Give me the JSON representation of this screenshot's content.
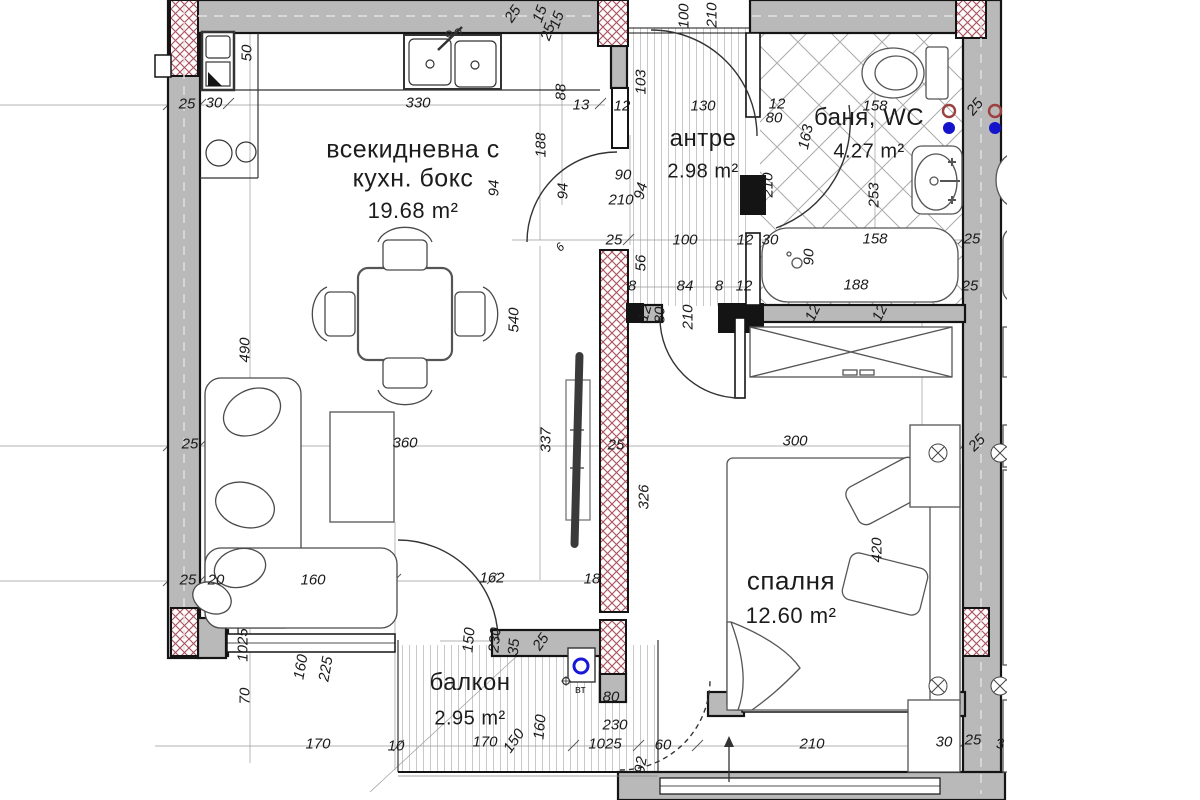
{
  "plan": {
    "rooms": [
      {
        "lines": [
          "всекидневна с",
          "кухн. бокс"
        ],
        "area": "19.68 m²",
        "x": 413,
        "y": 150,
        "lh": 29,
        "ns": 25,
        "as": 22,
        "ay": 211
      },
      {
        "lines": [
          "антре"
        ],
        "area": "2.98 m²",
        "x": 703,
        "y": 139,
        "lh": 26,
        "ns": 24,
        "as": 20,
        "ay": 172
      },
      {
        "lines": [
          "баня, WC"
        ],
        "area": "4.27 m²",
        "x": 869,
        "y": 118,
        "lh": 26,
        "ns": 24,
        "as": 20,
        "ay": 152
      },
      {
        "lines": [
          "спалня"
        ],
        "area": "12.60 m²",
        "x": 791,
        "y": 581,
        "lh": 28,
        "ns": 26,
        "as": 22,
        "ay": 616
      },
      {
        "lines": [
          "балкон"
        ],
        "area": "2.95 m²",
        "x": 470,
        "y": 683,
        "lh": 26,
        "ns": 24,
        "as": 20,
        "ay": 719
      }
    ],
    "dimensions": [
      [
        "50",
        247,
        53,
        -90
      ],
      [
        "25",
        187,
        104
      ],
      [
        "30",
        214,
        103
      ],
      [
        "330",
        418,
        103
      ],
      [
        "25",
        513,
        14,
        -55
      ],
      [
        "15",
        540,
        14,
        -70
      ],
      [
        "25",
        548,
        32,
        -70
      ],
      [
        "15",
        557,
        20,
        -70
      ],
      [
        "88",
        561,
        92,
        -90
      ],
      [
        "13",
        581,
        105
      ],
      [
        "12",
        622,
        106
      ],
      [
        "103",
        641,
        82,
        -90
      ],
      [
        "130",
        703,
        106
      ],
      [
        "100",
        684,
        16,
        -90
      ],
      [
        "210",
        712,
        15,
        -90
      ],
      [
        "188",
        541,
        145,
        -90
      ],
      [
        "94",
        494,
        188,
        -90
      ],
      [
        "94",
        563,
        191,
        -90
      ],
      [
        "94",
        641,
        191,
        -75
      ],
      [
        "90",
        623,
        175
      ],
      [
        "210",
        621,
        200
      ],
      [
        "12",
        777,
        104
      ],
      [
        "80",
        774,
        118
      ],
      [
        "210",
        768,
        185,
        -90
      ],
      [
        "163",
        806,
        137,
        -78
      ],
      [
        "158",
        875,
        106
      ],
      [
        "25",
        975,
        107,
        -50
      ],
      [
        "158",
        875,
        239
      ],
      [
        "253",
        874,
        195,
        -90
      ],
      [
        "90",
        809,
        257,
        -90
      ],
      [
        "188",
        856,
        285
      ],
      [
        "100",
        685,
        240
      ],
      [
        "25",
        614,
        240
      ],
      [
        "6",
        560,
        247,
        -45,
        12
      ],
      [
        "12",
        745,
        240
      ],
      [
        "30",
        770,
        240
      ],
      [
        "56",
        641,
        263,
        -90
      ],
      [
        "8",
        632,
        286
      ],
      [
        "84",
        685,
        286
      ],
      [
        "8",
        719,
        286
      ],
      [
        "12",
        744,
        286
      ],
      [
        "12",
        645,
        313,
        -75
      ],
      [
        "80",
        660,
        315,
        -90
      ],
      [
        "210",
        688,
        317,
        -90
      ],
      [
        "12",
        813,
        313,
        -65
      ],
      [
        "12",
        880,
        313,
        -65
      ],
      [
        "25",
        972,
        239
      ],
      [
        "25",
        970,
        286
      ],
      [
        "540",
        514,
        320,
        -90
      ],
      [
        "490",
        245,
        350,
        -90
      ],
      [
        "360",
        405,
        443
      ],
      [
        "337",
        546,
        440,
        -90
      ],
      [
        "25",
        616,
        445
      ],
      [
        "300",
        795,
        441
      ],
      [
        "25",
        977,
        443,
        -45
      ],
      [
        "326",
        644,
        497,
        -90
      ],
      [
        "420",
        877,
        550,
        -90
      ],
      [
        "25",
        190,
        444
      ],
      [
        "25",
        188,
        580
      ],
      [
        "20",
        216,
        580
      ],
      [
        "160",
        313,
        580
      ],
      [
        "162",
        492,
        578
      ],
      [
        "18",
        592,
        579
      ],
      [
        "1025",
        243,
        645,
        -90
      ],
      [
        "70",
        245,
        696,
        -90
      ],
      [
        "160",
        301,
        667,
        -80
      ],
      [
        "225",
        326,
        669,
        -80
      ],
      [
        "170",
        318,
        744
      ],
      [
        "150",
        469,
        640,
        -85
      ],
      [
        "230",
        495,
        640,
        -85
      ],
      [
        "35",
        514,
        647,
        -85
      ],
      [
        "25",
        541,
        642,
        -55
      ],
      [
        "10",
        396,
        746
      ],
      [
        "170",
        485,
        742
      ],
      [
        "150",
        514,
        741,
        -55
      ],
      [
        "160",
        540,
        727,
        -85
      ],
      [
        "1025",
        605,
        744
      ],
      [
        "60",
        663,
        745
      ],
      [
        "210",
        812,
        744
      ],
      [
        "30",
        944,
        742
      ],
      [
        "25",
        973,
        740
      ],
      [
        "3",
        1000,
        744
      ],
      [
        "80",
        611,
        697
      ],
      [
        "230",
        615,
        725
      ],
      [
        "92",
        641,
        765,
        -80
      ]
    ],
    "symbols": {
      "vt_label": "вт"
    },
    "colors": {
      "wall": "#b9b9b9",
      "line": "#141414",
      "hatch_red": "#a8505c",
      "plumbing_blue": "#1414cc",
      "plumbing_red": "#9c4040"
    }
  }
}
